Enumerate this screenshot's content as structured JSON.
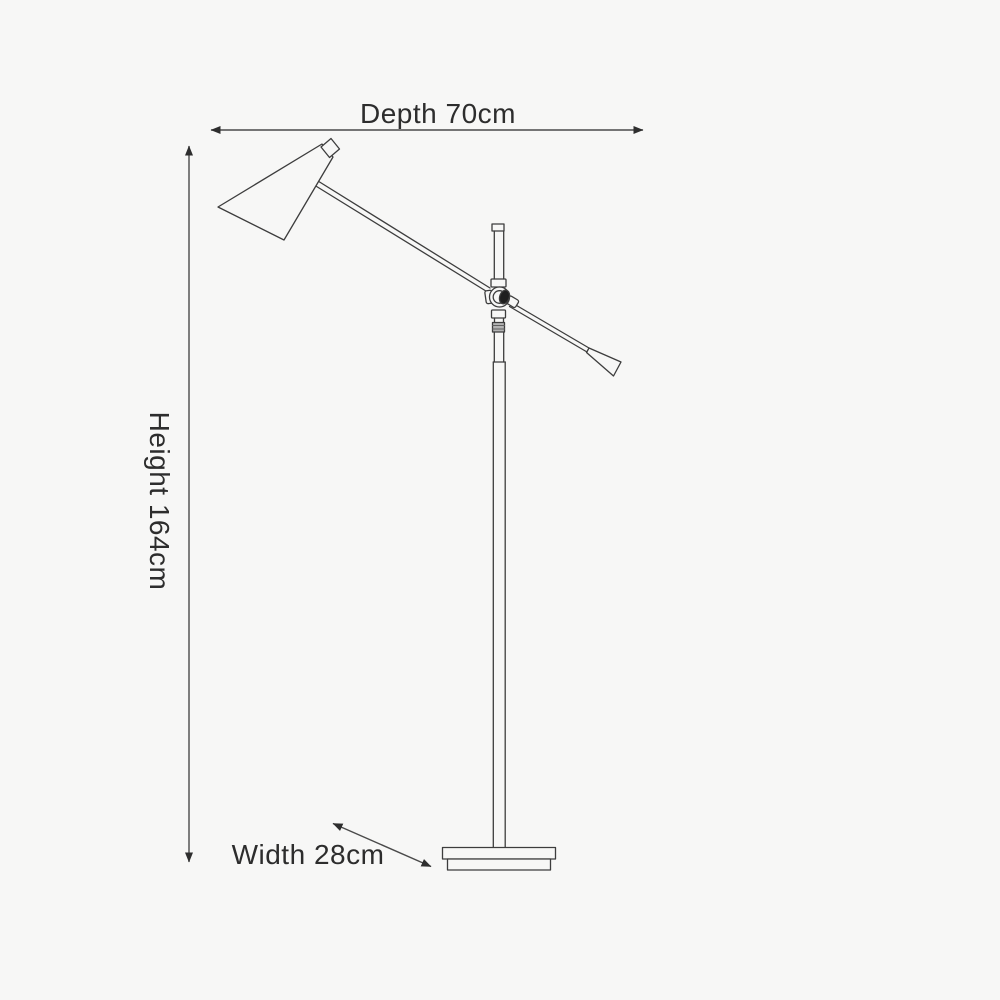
{
  "diagram": {
    "type": "product-dimension-diagram",
    "subject": "floor-lamp-line-drawing",
    "dimensions": {
      "depth": {
        "label": "Depth 70cm",
        "value": 70,
        "unit": "cm",
        "arrow": "horizontal-double"
      },
      "height": {
        "label": "Height 164cm",
        "value": 164,
        "unit": "cm",
        "arrow": "vertical-double"
      },
      "width": {
        "label": "Width 28cm",
        "value": 28,
        "unit": "cm",
        "arrow": "diagonal-double"
      }
    },
    "colors": {
      "background": "#f7f7f6",
      "line": "#3d3d3d",
      "text": "#2d2d2d",
      "knob_fill": "#1f1f1f",
      "band_fill": "#b3b3b3"
    }
  }
}
